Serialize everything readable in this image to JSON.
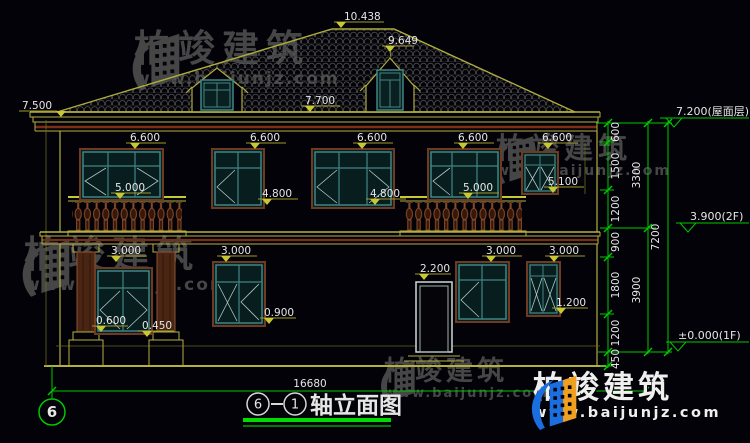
{
  "background": "#020208",
  "colors": {
    "line_yellow": "#b4b040",
    "dim_yellow": "#a09a28",
    "line_green": "#00c800",
    "underline_green": "#00dc00",
    "maroon_trim": "#7a2e16",
    "window_teal": "#418585",
    "window_wood": "#6e3a20",
    "baluster_brown": "#8a4a26",
    "text_white": "#e6e6e6",
    "watermark_gray": "#464646",
    "logo_blue": "#1a6ee0",
    "logo_orange": "#f0a020"
  },
  "brand": {
    "name": "柏竣建筑",
    "url": "www.baijunjz.com"
  },
  "levels": {
    "ridge": "10.438",
    "dormer": "9.649",
    "eave_top": "7.700",
    "eave_left": "7.500",
    "win2f_head": "6.600",
    "rail": "5.000",
    "sill2f": "4.800",
    "sill2f_small": "5.100",
    "floor2_head": "3.000",
    "door_head": "2.200",
    "sill_mid": "0.900",
    "sill_porch": "0.600",
    "plinth": "0.450",
    "sill_right": "1.200"
  },
  "chain": {
    "seg_600": "600",
    "seg_1500": "1500",
    "seg_1200_upper": "1200",
    "seg_900": "900",
    "seg_1800": "1800",
    "seg_1200_lower": "1200",
    "seg_450": "450",
    "sub_3300": "3300",
    "sub_3900": "3900",
    "total_7200": "7200",
    "elev_roof": "7.200(屋面层)",
    "elev_2f": "3.900(2F)",
    "elev_1f": "±0.000(1F)"
  },
  "footer": {
    "overall_width": "16680",
    "axis_bubble": "6",
    "title_axis_start": "6",
    "title_axis_end": "1",
    "title_text": "轴立面图"
  }
}
